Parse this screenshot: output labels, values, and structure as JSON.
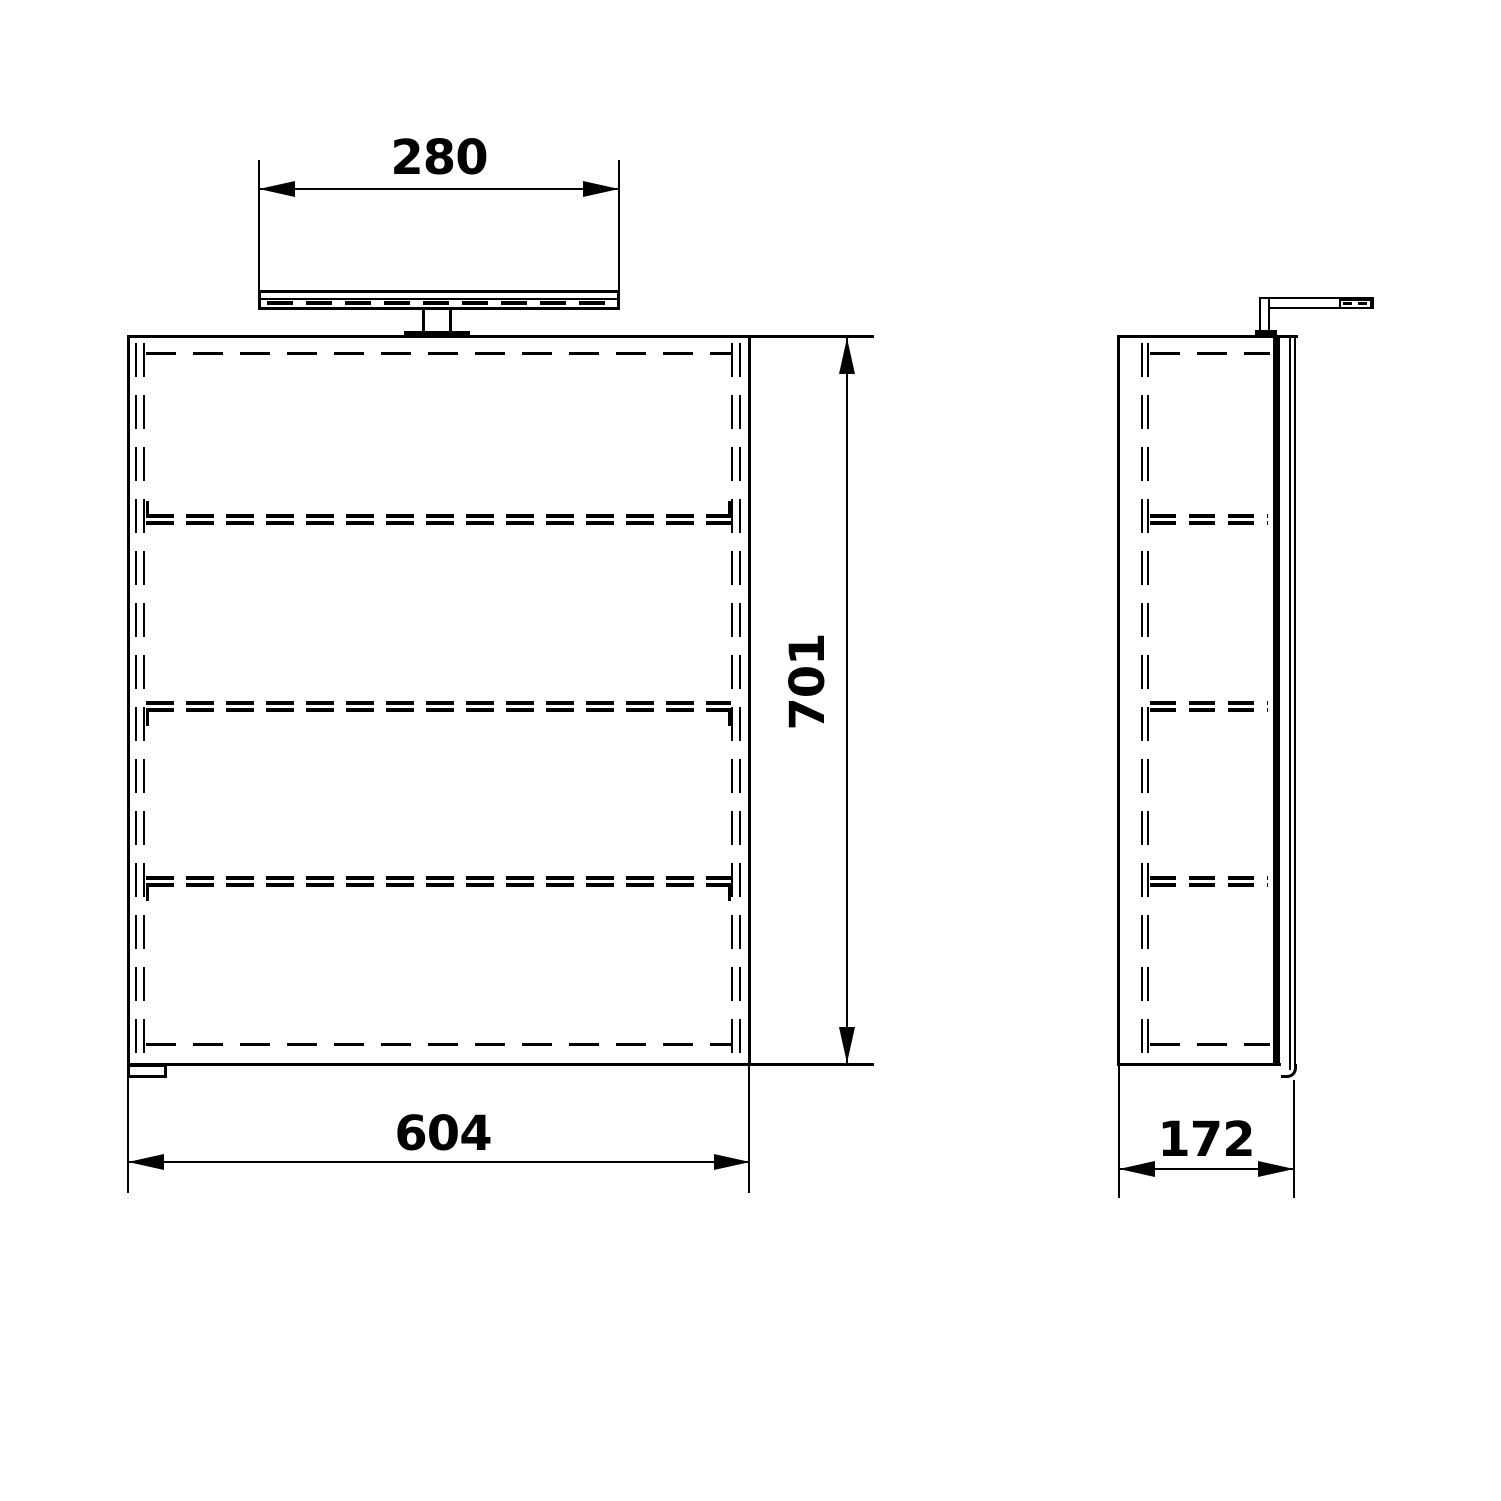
{
  "colors": {
    "background": "#ffffff",
    "line": "#000000",
    "text": "#000000"
  },
  "dimensions": {
    "lamp_width": "280",
    "cabinet_height": "701",
    "cabinet_width": "604",
    "cabinet_depth": "172"
  }
}
